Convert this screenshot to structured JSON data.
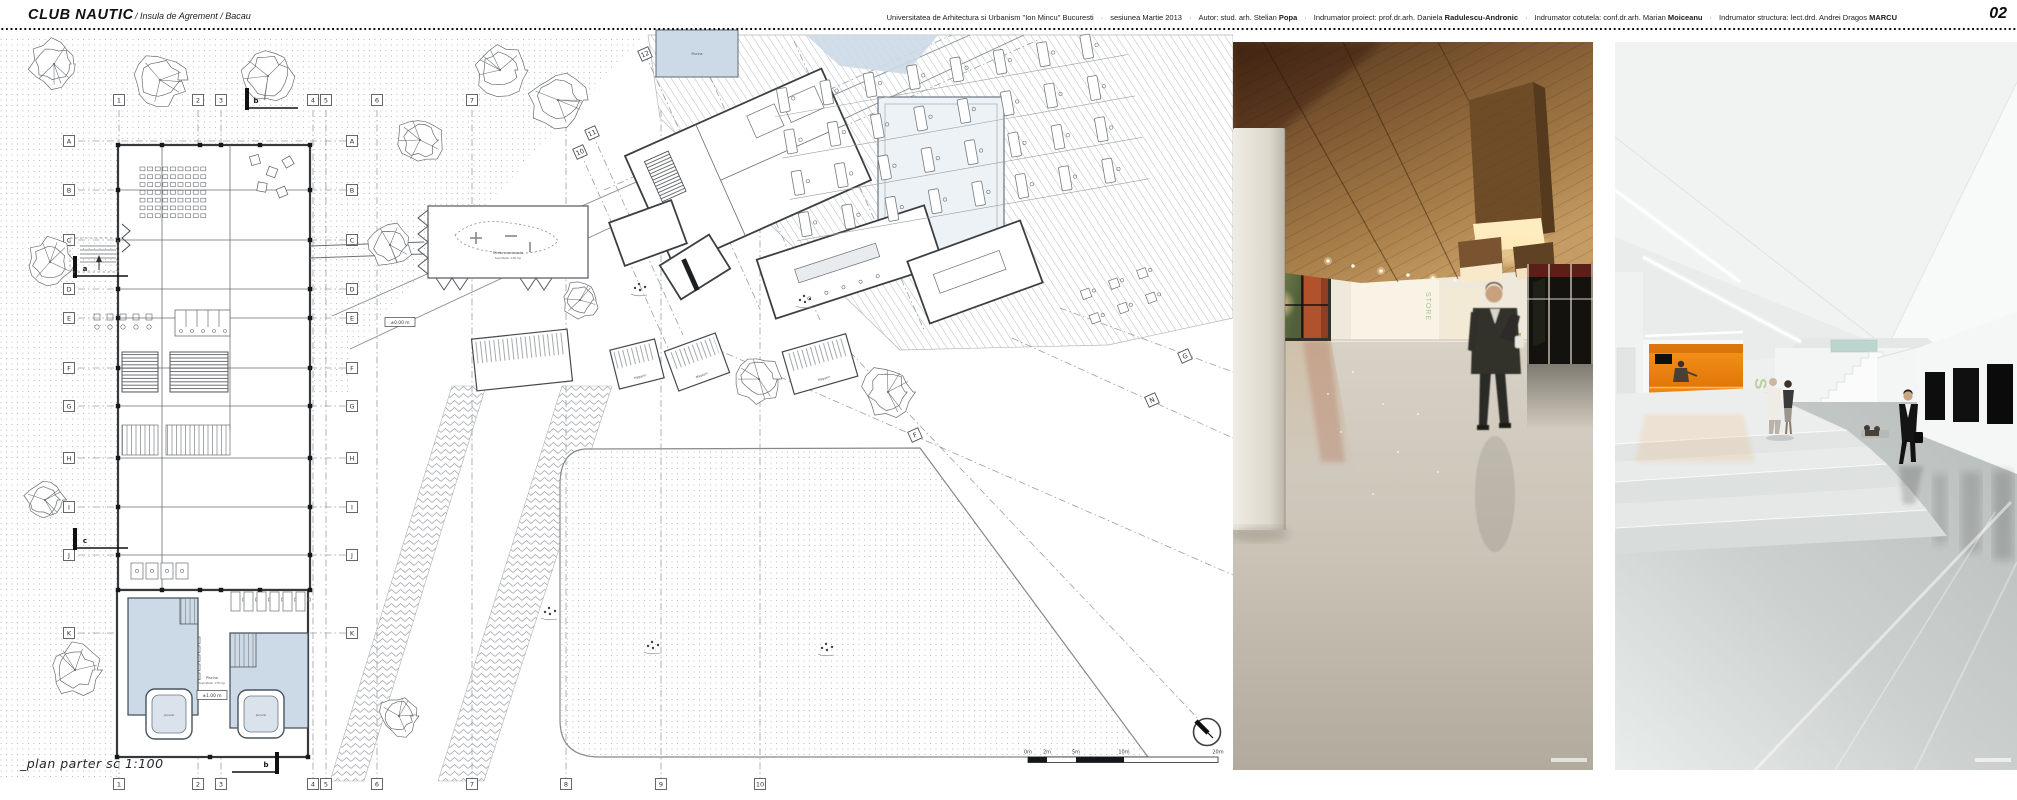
{
  "header": {
    "title": "CLUB NAUTIC",
    "subtitle": "/ Insula de Agrement  / Bacau",
    "credits_separator": "·",
    "credits": [
      {
        "pre": "Universitatea de Arhitectura si Urbanism \"Ion Mincu\" Bucuresti",
        "bold": ""
      },
      {
        "pre": "sesiunea Martie 2013",
        "bold": ""
      },
      {
        "pre": "Autor: stud. arh. Stelian",
        "bold": "Popa"
      },
      {
        "pre": "Indrumator proiect: prof.dr.arh. Daniela",
        "bold": "Radulescu-Andronic"
      },
      {
        "pre": "Indrumator cotutela: conf.dr.arh. Marian",
        "bold": "Moiceanu"
      },
      {
        "pre": "Indrumator structura: lect.drd. Andrei Dragos",
        "bold": "MARCU"
      }
    ],
    "page_number": "02"
  },
  "plan": {
    "label": "_plan parter sc 1:100",
    "grid_columns": [
      "1",
      "2",
      "3",
      "4",
      "5",
      "6",
      "7",
      "8",
      "9",
      "10"
    ],
    "grid_rows": [
      "A",
      "B",
      "C",
      "D",
      "E",
      "F",
      "G",
      "H",
      "I",
      "J",
      "K"
    ],
    "diagonal_grid_marks": [
      "12",
      "A'",
      "11",
      "10",
      "B'",
      "D'",
      "F",
      "G",
      "N"
    ],
    "section_marks": [
      "a",
      "b",
      "c"
    ],
    "scale_bar_labels": [
      "0m",
      "2m",
      "5m",
      "10m",
      "20m"
    ],
    "small_labels": {
      "pool": "Piscina",
      "pool_area": "Suprafata: 178 mp",
      "jacuzzi": "Jacuzzi",
      "shop": "Magazin",
      "terrace": "Terasa evenimente",
      "terrace_area": "Suprafata: 130 mp",
      "level_zero": "±0.00 m",
      "level_one": "±1.00 m"
    }
  },
  "renders": {
    "render1": {
      "sign_text": "STORE"
    },
    "render2": {
      "sign_text": "SPA"
    }
  },
  "colors": {
    "accent_orange": "#ee8413",
    "wood_brown": "#9b7344",
    "pool_blue": "#ccd9e6",
    "spa_green": "#b7c796",
    "drawing_line": "#3a3d40"
  }
}
